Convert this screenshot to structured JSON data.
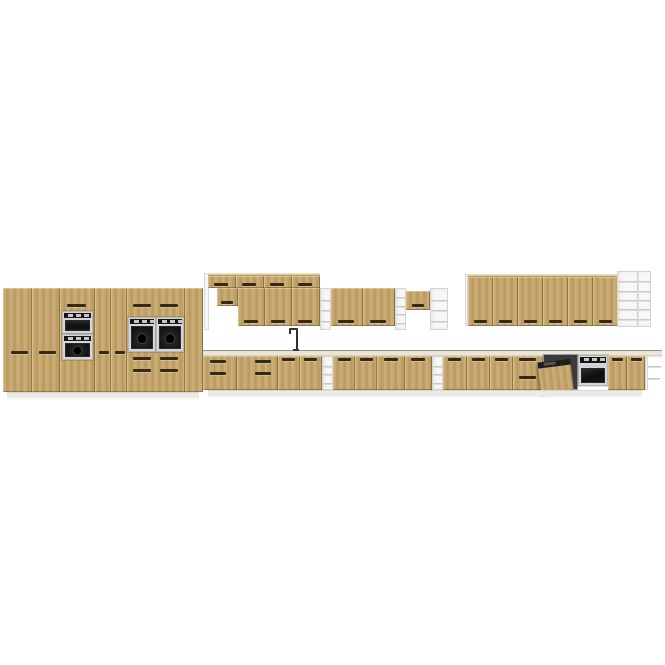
{
  "page": {
    "background": "#ffffff",
    "description": "3D product render of a modular kitchen furniture set: light oak handleless fronts, white open shelf units, built-in microwave, four ovens, dishwasher with open door, sink faucet, white worktop and plinths, on a plain white background"
  },
  "palette": {
    "wood": "#c7a76c",
    "wood_light": "#d5b77e",
    "wood_dark": "#ab8c52",
    "groove": "#342a18",
    "white_panel": "#f7f7f6",
    "panel_edge": "#d4d4d3",
    "counter": "#ebe4d9",
    "counter_edge": "#9f8f82",
    "appliance_dark": "#161616",
    "steel": "#d6d6d6",
    "plinth": "#eceae8"
  },
  "scene": {
    "width": 665,
    "height": 665,
    "units": [
      {
        "name": "tall-cabinet-left-door-1",
        "kind": "wood-door",
        "rect": [
          3,
          288,
          29,
          104
        ],
        "grooves": [
          [
            11,
            351,
            17
          ]
        ]
      },
      {
        "name": "tall-cabinet-left-door-2",
        "kind": "wood-door",
        "rect": [
          32,
          288,
          28,
          104
        ],
        "grooves": [
          [
            39,
            351,
            17
          ]
        ]
      },
      {
        "name": "tall-appliance-tower",
        "kind": "wood-door",
        "rect": [
          60,
          288,
          35,
          104
        ],
        "grooves": [
          [
            67,
            304,
            19
          ]
        ]
      },
      {
        "name": "built-in-microwave",
        "kind": "micro",
        "rect": [
          62,
          311,
          31,
          23
        ]
      },
      {
        "name": "built-in-oven-tower",
        "kind": "oven-round",
        "rect": [
          62,
          334,
          31,
          26
        ]
      },
      {
        "name": "tall-cabinet-mid-door-1",
        "kind": "wood-door",
        "rect": [
          95,
          288,
          16,
          104
        ],
        "grooves": [
          [
            99,
            351,
            10
          ]
        ]
      },
      {
        "name": "tall-cabinet-mid-door-2",
        "kind": "wood-door",
        "rect": [
          111,
          288,
          16,
          104
        ],
        "grooves": [
          [
            115,
            351,
            10
          ]
        ]
      },
      {
        "name": "double-oven-housing",
        "kind": "wood-door",
        "rect": [
          127,
          288,
          58,
          104
        ],
        "grooves": [
          [
            133,
            304,
            18
          ],
          [
            160,
            304,
            18
          ],
          [
            133,
            357,
            18
          ],
          [
            160,
            357,
            18
          ],
          [
            133,
            369,
            18
          ],
          [
            160,
            369,
            18
          ]
        ]
      },
      {
        "name": "built-in-oven-left-a",
        "kind": "oven-round",
        "rect": [
          128,
          317,
          28,
          35
        ]
      },
      {
        "name": "built-in-oven-left-b",
        "kind": "oven-round",
        "rect": [
          156,
          317,
          28,
          35
        ]
      },
      {
        "name": "tall-cabinet-right-door",
        "kind": "wood-door",
        "rect": [
          185,
          288,
          18,
          104
        ]
      },
      {
        "name": "tall-block-plinth",
        "kind": "plinth",
        "rect": [
          7,
          392,
          192,
          6
        ]
      },
      {
        "name": "wall-end-panel-left",
        "kind": "panel",
        "rect": [
          204,
          273,
          5,
          57
        ]
      },
      {
        "name": "wall-top-row-face",
        "kind": "top-face",
        "rect": [
          208,
          273,
          112,
          3
        ]
      },
      {
        "name": "wall-top-door-1",
        "kind": "wood-door",
        "rect": [
          208,
          276,
          28,
          12
        ],
        "grooves": [
          [
            214,
            283,
            14
          ]
        ]
      },
      {
        "name": "wall-top-door-2",
        "kind": "wood-door",
        "rect": [
          236,
          276,
          28,
          12
        ],
        "grooves": [
          [
            242,
            283,
            14
          ]
        ]
      },
      {
        "name": "wall-top-door-3",
        "kind": "wood-door",
        "rect": [
          264,
          276,
          28,
          12
        ],
        "grooves": [
          [
            270,
            283,
            14
          ]
        ]
      },
      {
        "name": "wall-top-door-4",
        "kind": "wood-door",
        "rect": [
          292,
          276,
          28,
          12
        ],
        "grooves": [
          [
            298,
            283,
            14
          ]
        ]
      },
      {
        "name": "wall-cabinet-short-door",
        "kind": "wood-door",
        "rect": [
          217,
          288,
          21,
          18
        ],
        "grooves": [
          [
            221,
            301,
            12
          ]
        ]
      },
      {
        "name": "wall-cabinet-door-1",
        "kind": "wood-door",
        "rect": [
          238,
          288,
          27,
          38
        ],
        "grooves": [
          [
            244,
            320,
            14
          ]
        ]
      },
      {
        "name": "wall-cabinet-door-2",
        "kind": "wood-door",
        "rect": [
          265,
          288,
          27,
          38
        ],
        "grooves": [
          [
            271,
            320,
            14
          ]
        ]
      },
      {
        "name": "wall-cabinet-door-3",
        "kind": "wood-door",
        "rect": [
          292,
          288,
          28,
          38
        ],
        "grooves": [
          [
            298,
            320,
            14
          ]
        ]
      },
      {
        "name": "open-shelf-column-1",
        "kind": "white-shelf",
        "rect": [
          320,
          288,
          11,
          42
        ],
        "shelves": 3
      },
      {
        "name": "wall-cabinet2-door-1",
        "kind": "wood-door",
        "rect": [
          331,
          288,
          32,
          38
        ],
        "grooves": [
          [
            338,
            320,
            16
          ]
        ]
      },
      {
        "name": "wall-cabinet2-door-2",
        "kind": "wood-door",
        "rect": [
          363,
          288,
          32,
          38
        ],
        "grooves": [
          [
            370,
            320,
            16
          ]
        ]
      },
      {
        "name": "open-shelf-column-2",
        "kind": "white-shelf",
        "rect": [
          395,
          288,
          11,
          42
        ],
        "shelves": 4
      },
      {
        "name": "small-wall-cabinet-door",
        "kind": "wood-door",
        "rect": [
          406,
          291,
          24,
          19
        ],
        "grooves": [
          [
            412,
            304,
            12
          ]
        ]
      },
      {
        "name": "open-shelf-unit-mid",
        "kind": "white-shelf",
        "rect": [
          430,
          288,
          18,
          42
        ],
        "shelves": 3
      },
      {
        "name": "wall-run-end-panel",
        "kind": "panel",
        "rect": [
          465,
          274,
          3,
          52
        ]
      },
      {
        "name": "wall-run-top-face",
        "kind": "top-face",
        "rect": [
          468,
          274,
          150,
          3
        ]
      },
      {
        "name": "wall-run-door-1",
        "kind": "wood-door",
        "rect": [
          468,
          277,
          25,
          49
        ],
        "grooves": [
          [
            474,
            320,
            13
          ]
        ]
      },
      {
        "name": "wall-run-door-2",
        "kind": "wood-door",
        "rect": [
          493,
          277,
          25,
          49
        ],
        "grooves": [
          [
            499,
            320,
            13
          ]
        ]
      },
      {
        "name": "wall-run-door-3",
        "kind": "wood-door",
        "rect": [
          518,
          277,
          25,
          49
        ],
        "grooves": [
          [
            524,
            320,
            13
          ]
        ]
      },
      {
        "name": "wall-run-door-4",
        "kind": "wood-door",
        "rect": [
          543,
          277,
          25,
          49
        ],
        "grooves": [
          [
            549,
            320,
            13
          ]
        ]
      },
      {
        "name": "wall-run-door-5",
        "kind": "wood-door",
        "rect": [
          568,
          277,
          25,
          49
        ],
        "grooves": [
          [
            574,
            320,
            13
          ]
        ]
      },
      {
        "name": "wall-run-door-6",
        "kind": "wood-door",
        "rect": [
          593,
          277,
          25,
          49
        ],
        "grooves": [
          [
            599,
            320,
            13
          ]
        ]
      },
      {
        "name": "open-shelf-tower",
        "kind": "white-shelf",
        "rect": [
          617,
          271,
          34,
          56
        ],
        "shelves": 5,
        "divider": true
      },
      {
        "name": "countertop",
        "kind": "counter",
        "rect": [
          203,
          350,
          459,
          6
        ]
      },
      {
        "name": "sink-faucet",
        "kind": "faucet",
        "rect": [
          289,
          328,
          11,
          23
        ]
      },
      {
        "name": "base-drawer-bank-1",
        "kind": "wood-door",
        "rect": [
          203,
          356,
          34,
          34
        ],
        "grooves": [
          [
            210,
            360,
            16
          ],
          [
            210,
            372,
            16
          ]
        ]
      },
      {
        "name": "base-drawer-bank-2",
        "kind": "wood-door",
        "rect": [
          237,
          356,
          41,
          34
        ],
        "grooves": [
          [
            255,
            360,
            16
          ],
          [
            255,
            372,
            16
          ]
        ]
      },
      {
        "name": "base-sink-door-1",
        "kind": "wood-door",
        "rect": [
          278,
          356,
          22,
          34
        ],
        "grooves": [
          [
            282,
            358,
            13
          ]
        ]
      },
      {
        "name": "base-sink-door-2",
        "kind": "wood-door",
        "rect": [
          300,
          356,
          22,
          34
        ],
        "grooves": [
          [
            304,
            358,
            13
          ]
        ]
      },
      {
        "name": "open-shelf-base-1",
        "kind": "white-shelf",
        "rect": [
          322,
          356,
          11,
          34
        ],
        "shelves": 3
      },
      {
        "name": "base-cabinet-door-3",
        "kind": "wood-door",
        "rect": [
          333,
          356,
          22,
          34
        ],
        "grooves": [
          [
            338,
            358,
            13
          ]
        ]
      },
      {
        "name": "base-cabinet-door-4",
        "kind": "wood-door",
        "rect": [
          355,
          356,
          22,
          34
        ],
        "grooves": [
          [
            360,
            358,
            13
          ]
        ]
      },
      {
        "name": "base-cabinet-door-5",
        "kind": "wood-door",
        "rect": [
          377,
          356,
          28,
          34
        ],
        "grooves": [
          [
            384,
            358,
            14
          ]
        ]
      },
      {
        "name": "base-cabinet-door-6",
        "kind": "wood-door",
        "rect": [
          405,
          356,
          27,
          34
        ],
        "grooves": [
          [
            411,
            358,
            14
          ]
        ]
      },
      {
        "name": "open-shelf-base-2",
        "kind": "white-shelf",
        "rect": [
          432,
          356,
          11,
          34
        ],
        "shelves": 3
      },
      {
        "name": "base-cabinet-door-7",
        "kind": "wood-door",
        "rect": [
          443,
          356,
          24,
          34
        ],
        "grooves": [
          [
            448,
            358,
            13
          ]
        ]
      },
      {
        "name": "base-cabinet-door-8",
        "kind": "wood-door",
        "rect": [
          467,
          356,
          23,
          34
        ],
        "grooves": [
          [
            472,
            358,
            13
          ]
        ]
      },
      {
        "name": "base-cabinet-door-9",
        "kind": "wood-door",
        "rect": [
          490,
          356,
          23,
          34
        ],
        "grooves": [
          [
            495,
            358,
            13
          ]
        ]
      },
      {
        "name": "base-drawer-bank-3",
        "kind": "wood-door",
        "rect": [
          513,
          356,
          30,
          34
        ],
        "grooves": [
          [
            519,
            358,
            17
          ],
          [
            519,
            376,
            17
          ]
        ]
      },
      {
        "name": "dishwasher-open-door",
        "kind": "dishwasher",
        "rect": [
          543,
          354,
          35,
          36
        ]
      },
      {
        "name": "built-in-oven-right",
        "kind": "oven",
        "rect": [
          578,
          355,
          30,
          31
        ]
      },
      {
        "name": "base-cabinet-door-10",
        "kind": "wood-door",
        "rect": [
          608,
          356,
          19,
          34
        ],
        "grooves": [
          [
            612,
            358,
            11
          ]
        ]
      },
      {
        "name": "base-cabinet-door-11",
        "kind": "wood-door",
        "rect": [
          627,
          356,
          18,
          34
        ],
        "grooves": [
          [
            631,
            358,
            11
          ]
        ]
      },
      {
        "name": "end-shelf-side-panel",
        "kind": "panel",
        "rect": [
          645,
          356,
          3,
          34
        ]
      },
      {
        "name": "end-shelf-line-1",
        "kind": "shelf-edge",
        "rect": [
          648,
          366,
          13,
          2
        ]
      },
      {
        "name": "end-shelf-line-2",
        "kind": "shelf-edge",
        "rect": [
          648,
          378,
          12,
          2
        ]
      },
      {
        "name": "base-run-plinth",
        "kind": "plinth",
        "rect": [
          208,
          390,
          434,
          6
        ]
      }
    ]
  }
}
